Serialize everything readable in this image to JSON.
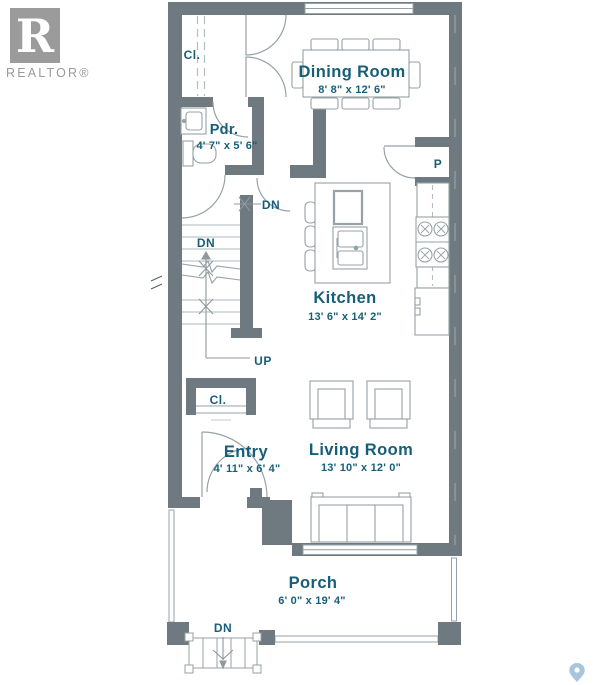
{
  "branding": {
    "logo_r": "R",
    "logo_text": "REALTOR®"
  },
  "rooms": {
    "dining": {
      "name": "Dining Room",
      "dims": "8' 8\" x 12' 6\""
    },
    "powder": {
      "name": "Pdr.",
      "dims": "4' 7\" x 5' 6\""
    },
    "kitchen": {
      "name": "Kitchen",
      "dims": "13' 6\" x 14' 2\""
    },
    "entry": {
      "name": "Entry",
      "dims": "4' 11\" x 6' 4\""
    },
    "living": {
      "name": "Living Room",
      "dims": "13' 10\" x 12' 0\""
    },
    "porch": {
      "name": "Porch",
      "dims": "6' 0\" x 19' 4\""
    }
  },
  "labels": {
    "closet_upper": "Cl.",
    "closet_entry": "Cl.",
    "pantry": "P",
    "stairs_down_upper": "DN",
    "stairs_down": "DN",
    "stairs_up": "UP",
    "porch_steps_down": "DN"
  },
  "colors": {
    "wall": "#6F7A80",
    "furniture_line": "#97A1A6",
    "light_line": "#B4BDC1",
    "label_text": "#175E79",
    "logo_gray": "#9B9B9B",
    "map_pin": "#A9C4DB"
  }
}
